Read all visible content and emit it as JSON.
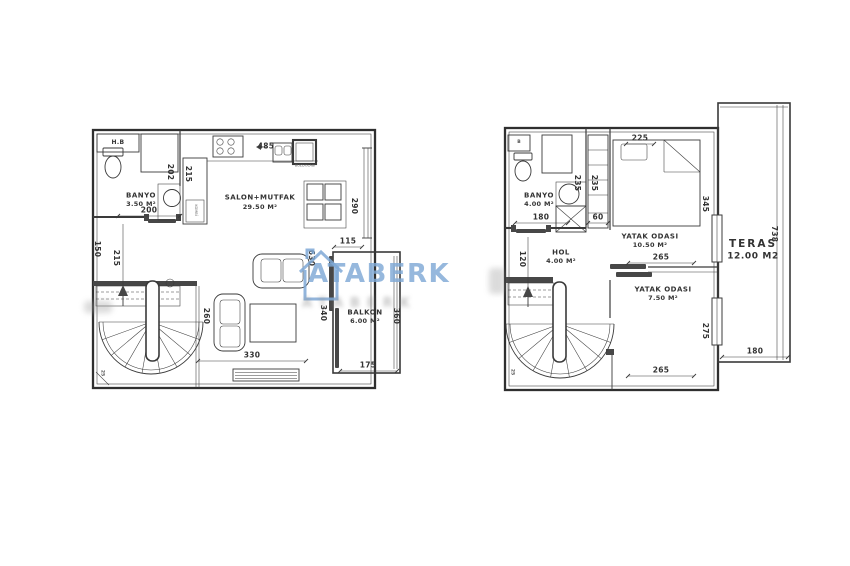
{
  "watermark": {
    "brand": "ATABERK",
    "shadow_text": "ATABERK",
    "brand_color": "#7fa9d6"
  },
  "ground_floor": {
    "rooms": {
      "hb": {
        "label": "H.B"
      },
      "banyo": {
        "name": "BANYO",
        "area": "3.50 M²"
      },
      "salon": {
        "name": "SALON+MUTFAK",
        "area": "29.50 M²"
      },
      "balkon": {
        "name": "BALKON",
        "area": "6.00 M²"
      },
      "kombi_label": "KOMBİ",
      "fridge_label": "BUZDOLABI"
    },
    "dims": {
      "d200": "200",
      "d202": "202",
      "d215_top": "215",
      "d150": "150",
      "d215_left": "215",
      "d485": "485",
      "d290": "290",
      "d115": "115",
      "d630": "630",
      "d340": "340",
      "d260": "260",
      "d360": "360",
      "d330": "330",
      "d175": "175",
      "d25": "25"
    }
  },
  "upper_floor": {
    "rooms": {
      "b": {
        "label": "B"
      },
      "banyo": {
        "name": "BANYO",
        "area": "4.00 M²"
      },
      "hol": {
        "name": "HOL",
        "area": "4.00 M²"
      },
      "yatak1": {
        "name": "YATAK ODASI",
        "area": "10.50 M²"
      },
      "yatak2": {
        "name": "YATAK ODASI",
        "area": "7.50 M²"
      },
      "teras": {
        "name": "TERAS",
        "area": "12.00 M2"
      }
    },
    "dims": {
      "d180_banyo": "180",
      "d235_a": "235",
      "d235_b": "235",
      "d60": "60",
      "d225": "225",
      "d345": "345",
      "d265_mid": "265",
      "d120": "120",
      "d265_bottom": "265",
      "d275": "275",
      "d738": "738",
      "d180_teras": "180",
      "d25": "25"
    }
  }
}
